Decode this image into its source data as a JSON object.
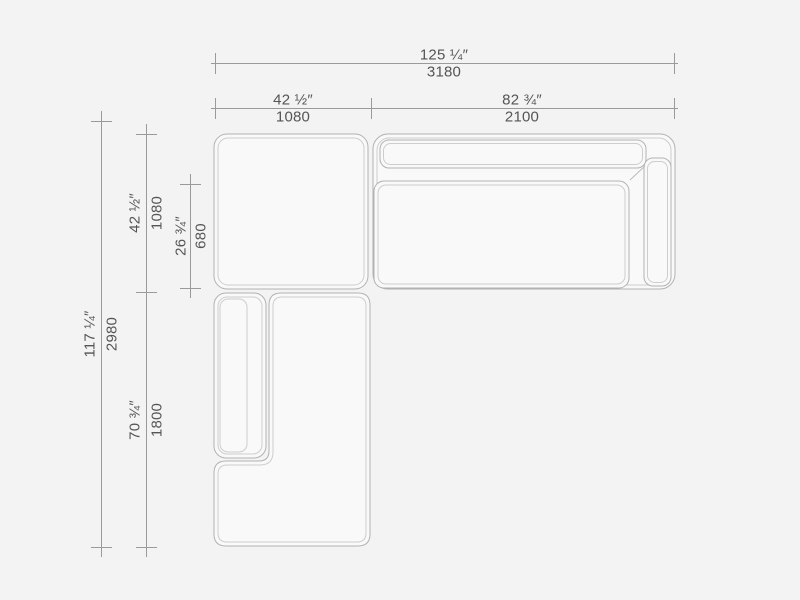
{
  "dims": {
    "overall_width": {
      "inches": "125 ¼″",
      "mm": "3180"
    },
    "left_width": {
      "inches": "42 ½″",
      "mm": "1080"
    },
    "right_width": {
      "inches": "82 ¾″",
      "mm": "2100"
    },
    "overall_depth": {
      "inches": "117 ¼″",
      "mm": "2980"
    },
    "ottoman_depth": {
      "inches": "42 ½″",
      "mm": "1080"
    },
    "seat_depth": {
      "inches": "26 ¾″",
      "mm": "680"
    },
    "chaise_length": {
      "inches": "70 ¾″",
      "mm": "1800"
    }
  },
  "colors": {
    "background": "#f3f3f3",
    "dimension_line": "#9a9a9a",
    "text": "#555555",
    "sofa_outline": "#b2b2b2",
    "sofa_inner_line": "#cdcdcd",
    "sofa_fill": "#f9f9f9"
  }
}
